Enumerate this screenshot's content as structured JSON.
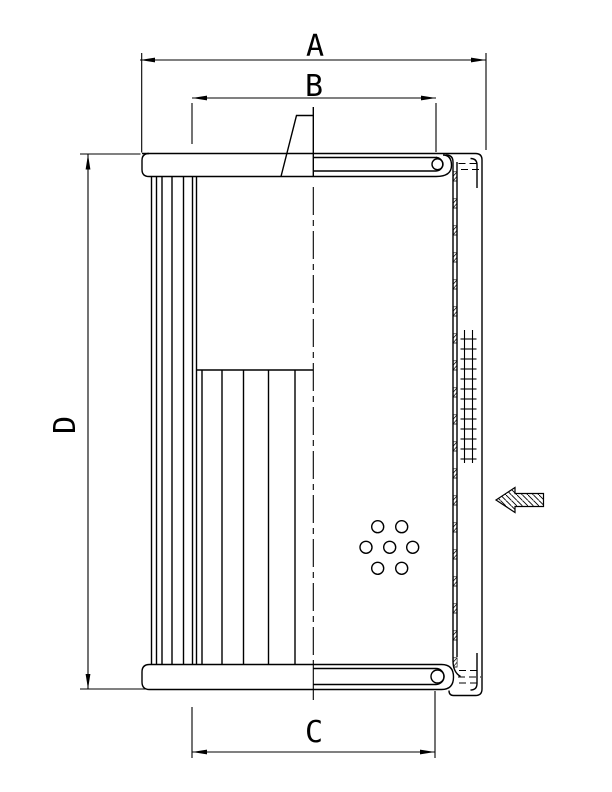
{
  "drawing": {
    "labels": {
      "a": "A",
      "b": "B",
      "c": "C",
      "d": "D"
    },
    "colors": {
      "line": "#000000",
      "background": "#ffffff"
    },
    "icons": {
      "flow_direction": "flow-arrow-left"
    }
  }
}
